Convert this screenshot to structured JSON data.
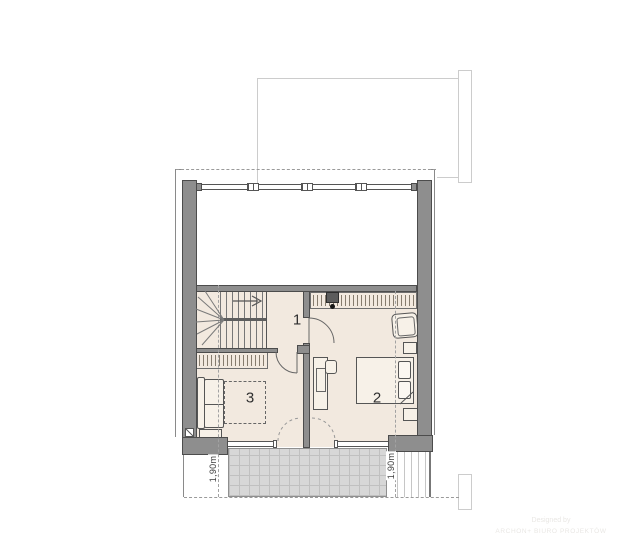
{
  "plan": {
    "rooms": [
      {
        "label": "1"
      },
      {
        "label": "2"
      },
      {
        "label": "3"
      }
    ],
    "height_marks": {
      "left": "1,90m",
      "right": "1,90m"
    },
    "watermark": {
      "line1": "Designed by",
      "line2": "ARCHON+ BIURO PROJEKTÓW"
    },
    "palette": {
      "wall_fill": "#8e8e8e",
      "wall_edge": "#4c4c4c",
      "floor_fill": "#f2e9df",
      "terrace_fill": "#d7d7d7",
      "drawing_line": "#555555",
      "light_outline": "#cccccc",
      "dashed_line": "#a2a2a2",
      "label_color": "#2f2f2f"
    }
  }
}
